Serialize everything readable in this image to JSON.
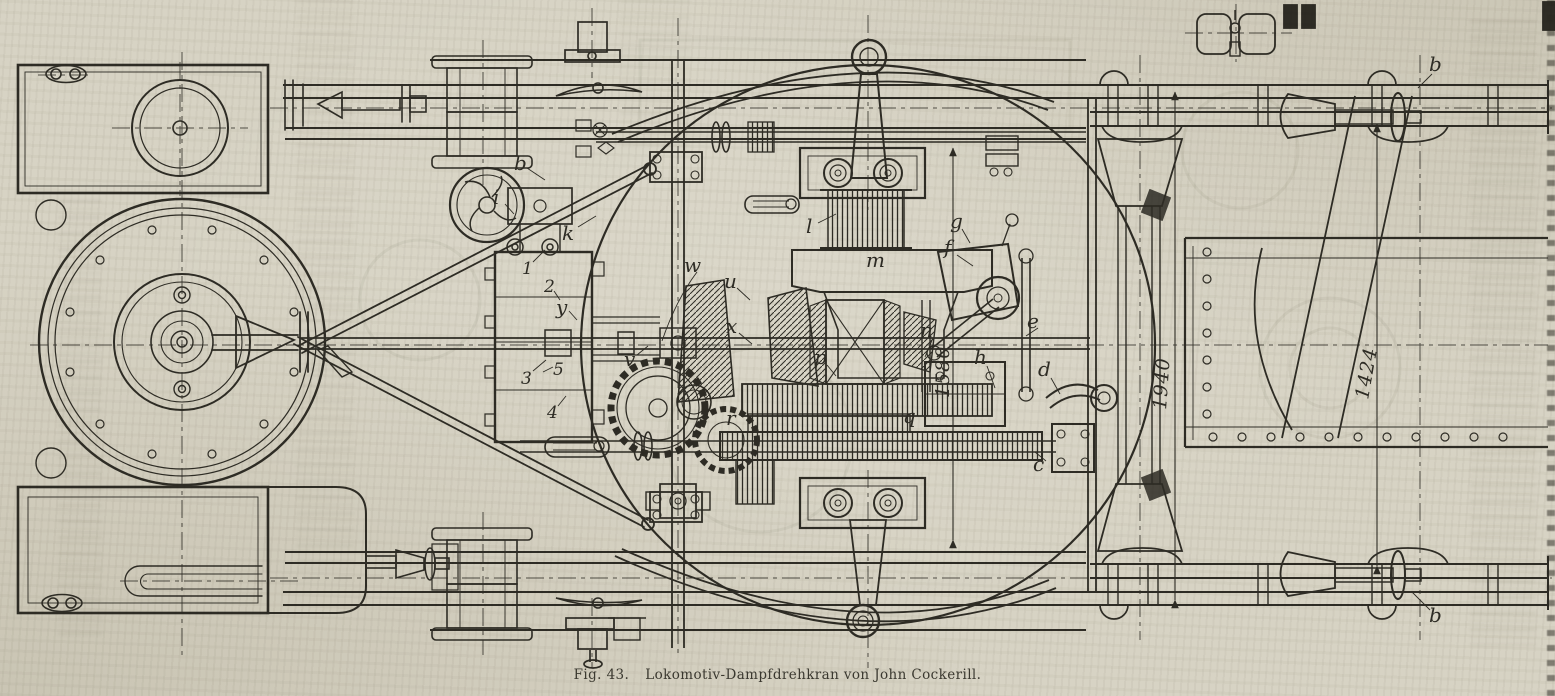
{
  "figure": {
    "caption_prefix": "Fig. 43.",
    "caption_title": "Lokomotiv-Dampfdrehkran von John Cockerill."
  },
  "colors": {
    "ink": "#2e2c25",
    "paper": "#d7d3c4"
  },
  "dims": [
    {
      "value": "1580"
    },
    {
      "value": "1940"
    },
    {
      "value": "1424"
    }
  ],
  "part_labels": [
    {
      "text": "b"
    },
    {
      "text": "i"
    },
    {
      "text": "k"
    },
    {
      "text": "1"
    },
    {
      "text": "2"
    },
    {
      "text": "y"
    },
    {
      "text": "3"
    },
    {
      "text": "5"
    },
    {
      "text": "4"
    },
    {
      "text": "v"
    },
    {
      "text": "w"
    },
    {
      "text": "u"
    },
    {
      "text": "x"
    },
    {
      "text": "l"
    },
    {
      "text": "m"
    },
    {
      "text": "g"
    },
    {
      "text": "f"
    },
    {
      "text": "n"
    },
    {
      "text": "e"
    },
    {
      "text": "h"
    },
    {
      "text": "d"
    },
    {
      "text": "p"
    },
    {
      "text": "q"
    },
    {
      "text": "r"
    },
    {
      "text": "c"
    },
    {
      "text": "b"
    },
    {
      "text": "b"
    }
  ]
}
